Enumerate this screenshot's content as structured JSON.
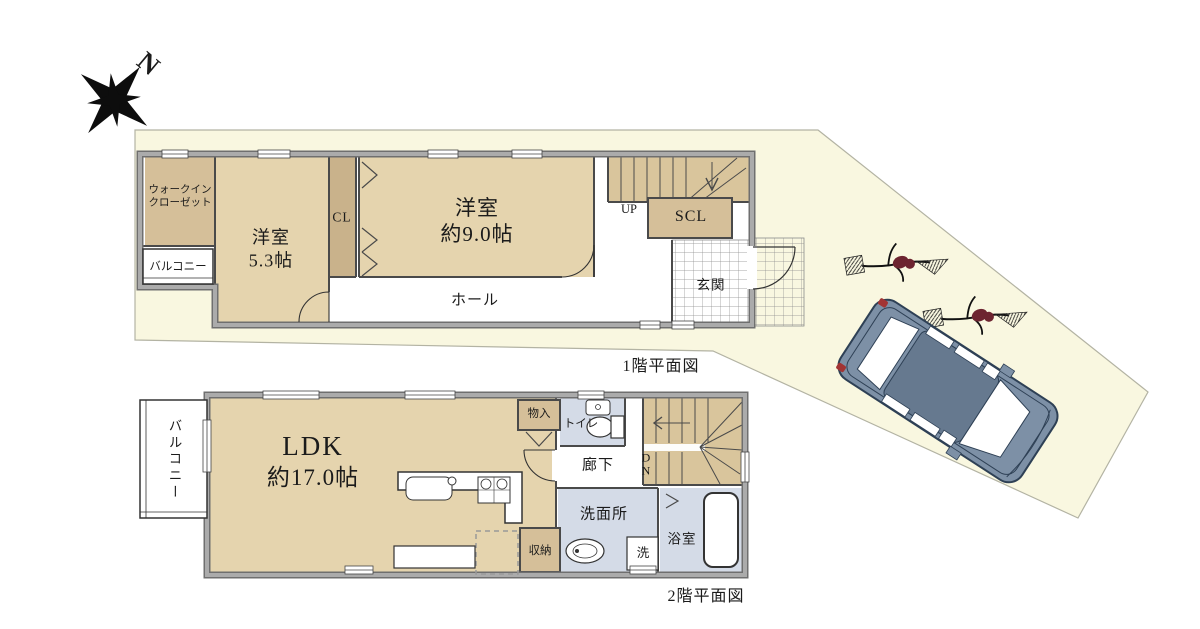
{
  "compass": {
    "label": "N"
  },
  "floor1": {
    "title": "1階平面図",
    "rooms": {
      "wic_line1": "ウォークイン",
      "wic_line2": "クローゼット",
      "balcony": "バルコニー",
      "bedroom53_name": "洋室",
      "bedroom53_size": "5.3帖",
      "closet": "CL",
      "bedroom90_name": "洋室",
      "bedroom90_size": "約9.0帖",
      "hall": "ホール",
      "stairs_up": "UP",
      "shoe_closet": "SCL",
      "entrance": "玄関"
    }
  },
  "floor2": {
    "title": "2階平面図",
    "rooms": {
      "balcony": "バルコニー",
      "ldk_name": "LDK",
      "ldk_size": "約17.0帖",
      "storage_monoire": "物入",
      "toilet": "トイレ",
      "corridor": "廊下",
      "stairs_down_line1": "D",
      "stairs_down_line2": "N",
      "washroom": "洗面所",
      "laundry": "洗",
      "bathroom": "浴室",
      "storage_shuno": "収納"
    }
  },
  "colors": {
    "site_fill": "#f9f7e0",
    "room_tan_light": "#e5d4ae",
    "room_tan_dark": "#d5bf99",
    "closet_tan": "#c9b28b",
    "stairs_tan": "#d9c59c",
    "wet_room_blue": "#d4dbe7",
    "wall_gray": "#a0a0a0",
    "car_body": "#7d90a6",
    "tree_accent": "#6d2430"
  }
}
